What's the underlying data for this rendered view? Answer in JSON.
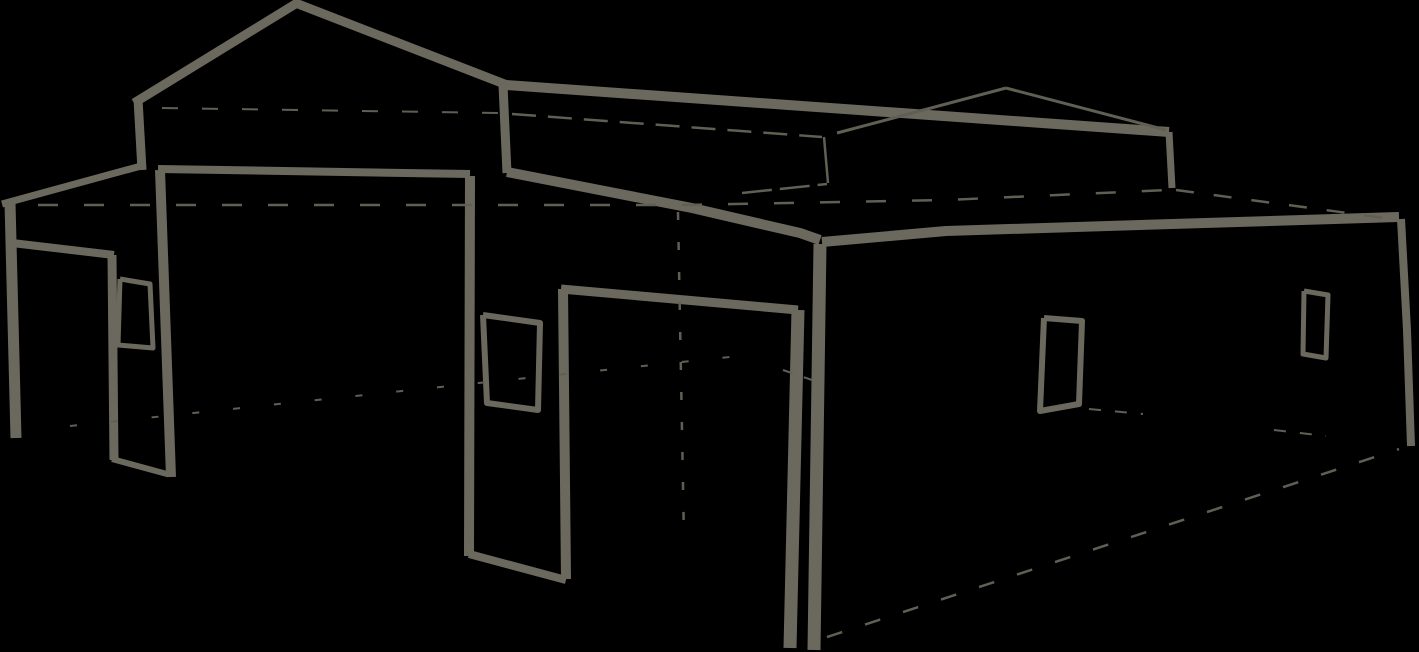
{
  "canvas": {
    "width": 1419,
    "height": 652,
    "background_color": "#000000",
    "stroke_color": "#6b695e",
    "construction_stroke_color": "#605f54"
  },
  "sketch": {
    "subject": "perspective line sketch of a metal garage building with lean-to carport, center gable and enclosed right section",
    "strokes": [
      {
        "name": "gable-left-roof-slope",
        "width": 9,
        "points": [
          [
            134,
            103
          ],
          [
            297,
            3
          ]
        ]
      },
      {
        "name": "gable-right-roof-slope",
        "width": 9,
        "points": [
          [
            293,
            2
          ],
          [
            507,
            85
          ]
        ]
      },
      {
        "name": "gable-left-wall-edge",
        "width": 9,
        "points": [
          [
            138,
            99
          ],
          [
            142,
            170
          ]
        ]
      },
      {
        "name": "lean-to-roof-edge",
        "width": 7,
        "points": [
          [
            2,
            204
          ],
          [
            141,
            166
          ]
        ]
      },
      {
        "name": "lean-to-left-post",
        "width": 11,
        "points": [
          [
            10,
            203
          ],
          [
            16,
            438
          ]
        ]
      },
      {
        "name": "gable-right-wall-edge",
        "width": 9,
        "points": [
          [
            503,
            85
          ],
          [
            507,
            173
          ]
        ]
      },
      {
        "name": "raised-roof-fascia",
        "width": 10,
        "points": [
          [
            506,
            85
          ],
          [
            1169,
            132
          ]
        ]
      },
      {
        "name": "raised-roof-back-corner-edge",
        "width": 7,
        "points": [
          [
            1169,
            132
          ],
          [
            1172,
            188
          ]
        ]
      },
      {
        "name": "raised-roof-back-ridge-left",
        "width": 3,
        "construction": true,
        "points": [
          [
            837,
            133
          ],
          [
            1006,
            88
          ]
        ]
      },
      {
        "name": "raised-roof-back-ridge-right",
        "width": 3,
        "construction": true,
        "points": [
          [
            1006,
            88
          ],
          [
            1166,
            130
          ]
        ]
      },
      {
        "name": "raised-roof-base-line",
        "width": 2.5,
        "construction": true,
        "dash": "24 12",
        "points": [
          [
            512,
            114
          ],
          [
            822,
            137
          ]
        ]
      },
      {
        "name": "back-wall-corner-line",
        "width": 2.5,
        "construction": true,
        "points": [
          [
            824,
            137
          ],
          [
            828,
            183
          ]
        ]
      },
      {
        "name": "back-wall-base-line",
        "width": 2.5,
        "construction": true,
        "dash": "30 8",
        "points": [
          [
            742,
            193
          ],
          [
            827,
            184
          ]
        ]
      },
      {
        "name": "main-eave-left",
        "width": 10,
        "points": [
          [
            507,
            172
          ],
          [
            692,
            208
          ],
          [
            800,
            233
          ],
          [
            820,
            240
          ]
        ]
      },
      {
        "name": "corner-post",
        "width": 13,
        "points": [
          [
            820,
            244
          ],
          [
            814,
            650
          ]
        ]
      },
      {
        "name": "main-eave-right",
        "width": 10,
        "points": [
          [
            822,
            242
          ],
          [
            946,
            231
          ],
          [
            1366,
            218
          ],
          [
            1399,
            217
          ]
        ]
      },
      {
        "name": "right-wall-corner-edge",
        "width": 8,
        "points": [
          [
            1401,
            219
          ],
          [
            1407,
            330
          ],
          [
            1411,
            446
          ]
        ]
      },
      {
        "name": "gable-opening-header",
        "width": 8,
        "points": [
          [
            158,
            169
          ],
          [
            470,
            174
          ]
        ]
      },
      {
        "name": "gable-opening-left-jamb",
        "width": 10,
        "points": [
          [
            160,
            170
          ],
          [
            171,
            477
          ]
        ]
      },
      {
        "name": "gable-opening-right-jamb",
        "width": 10,
        "points": [
          [
            470,
            176
          ],
          [
            469,
            556
          ]
        ]
      },
      {
        "name": "gable-opening-sill-line",
        "width": 8,
        "points": [
          [
            469,
            554
          ],
          [
            566,
            580
          ]
        ]
      },
      {
        "name": "lean-to-header",
        "width": 8,
        "points": [
          [
            12,
            243
          ],
          [
            114,
            255
          ]
        ]
      },
      {
        "name": "lean-to-right-post",
        "width": 9,
        "points": [
          [
            112,
            255
          ],
          [
            114,
            460
          ]
        ]
      },
      {
        "name": "lean-to-sill-line",
        "width": 6,
        "points": [
          [
            112,
            459
          ],
          [
            167,
            474
          ]
        ]
      },
      {
        "name": "left-wall-window-frame",
        "width": 5,
        "points": [
          [
            120,
            279
          ],
          [
            150,
            284
          ],
          [
            153,
            348
          ],
          [
            118,
            345
          ],
          [
            120,
            279
          ]
        ]
      },
      {
        "name": "front-opening-left-jamb",
        "width": 10,
        "points": [
          [
            563,
            289
          ],
          [
            566,
            579
          ]
        ]
      },
      {
        "name": "front-opening-header",
        "width": 9,
        "points": [
          [
            561,
            289
          ],
          [
            798,
            310
          ]
        ]
      },
      {
        "name": "front-opening-right-post",
        "width": 13,
        "points": [
          [
            798,
            310
          ],
          [
            790,
            648
          ]
        ]
      },
      {
        "name": "front-wall-window-frame",
        "width": 6,
        "points": [
          [
            483,
            315
          ],
          [
            540,
            323
          ],
          [
            538,
            410
          ],
          [
            487,
            403
          ],
          [
            483,
            315
          ]
        ]
      },
      {
        "name": "right-wall-window-near-frame",
        "width": 6,
        "points": [
          [
            1044,
            318
          ],
          [
            1082,
            321
          ],
          [
            1079,
            404
          ],
          [
            1040,
            411
          ],
          [
            1044,
            318
          ]
        ]
      },
      {
        "name": "right-wall-window-far-frame",
        "width": 5,
        "points": [
          [
            1304,
            291
          ],
          [
            1328,
            295
          ],
          [
            1326,
            358
          ],
          [
            1303,
            354
          ],
          [
            1304,
            291
          ]
        ]
      },
      {
        "name": "back-eave-hidden-line-left",
        "width": 2.5,
        "construction": true,
        "dash": "20 26",
        "points": [
          [
            38,
            205
          ],
          [
            680,
            205
          ],
          [
            946,
            200
          ],
          [
            1168,
            190
          ]
        ]
      },
      {
        "name": "back-eave-hidden-line-right",
        "width": 2.5,
        "construction": true,
        "dash": "18 20",
        "points": [
          [
            1176,
            190
          ],
          [
            1400,
            220
          ]
        ]
      },
      {
        "name": "interior-corner-hidden-line",
        "width": 2.5,
        "construction": true,
        "dash": "8 22",
        "points": [
          [
            678,
            212
          ],
          [
            684,
            540
          ]
        ]
      },
      {
        "name": "floor-hidden-line-left",
        "width": 2,
        "construction": true,
        "dash": "7 34",
        "points": [
          [
            70,
            426
          ],
          [
            450,
            386
          ],
          [
            730,
            357
          ]
        ]
      },
      {
        "name": "floor-hidden-line-right",
        "width": 2.5,
        "construction": true,
        "dash": "16 24",
        "points": [
          [
            827,
            637
          ],
          [
            1399,
            449
          ]
        ]
      },
      {
        "name": "floor-mark-near-posts",
        "width": 2,
        "construction": true,
        "dash": "10 12",
        "points": [
          [
            783,
            370
          ],
          [
            812,
            380
          ]
        ]
      },
      {
        "name": "floor-mark-right-a",
        "width": 2,
        "construction": true,
        "dash": "12 14",
        "points": [
          [
            1089,
            409
          ],
          [
            1143,
            414
          ]
        ]
      },
      {
        "name": "floor-mark-right-b",
        "width": 2,
        "construction": true,
        "dash": "12 14",
        "points": [
          [
            1274,
            430
          ],
          [
            1326,
            436
          ]
        ]
      },
      {
        "name": "hidden-eave-level-line",
        "width": 2,
        "construction": true,
        "dash": "16 24",
        "points": [
          [
            162,
            108
          ],
          [
            500,
            113
          ]
        ]
      }
    ]
  }
}
